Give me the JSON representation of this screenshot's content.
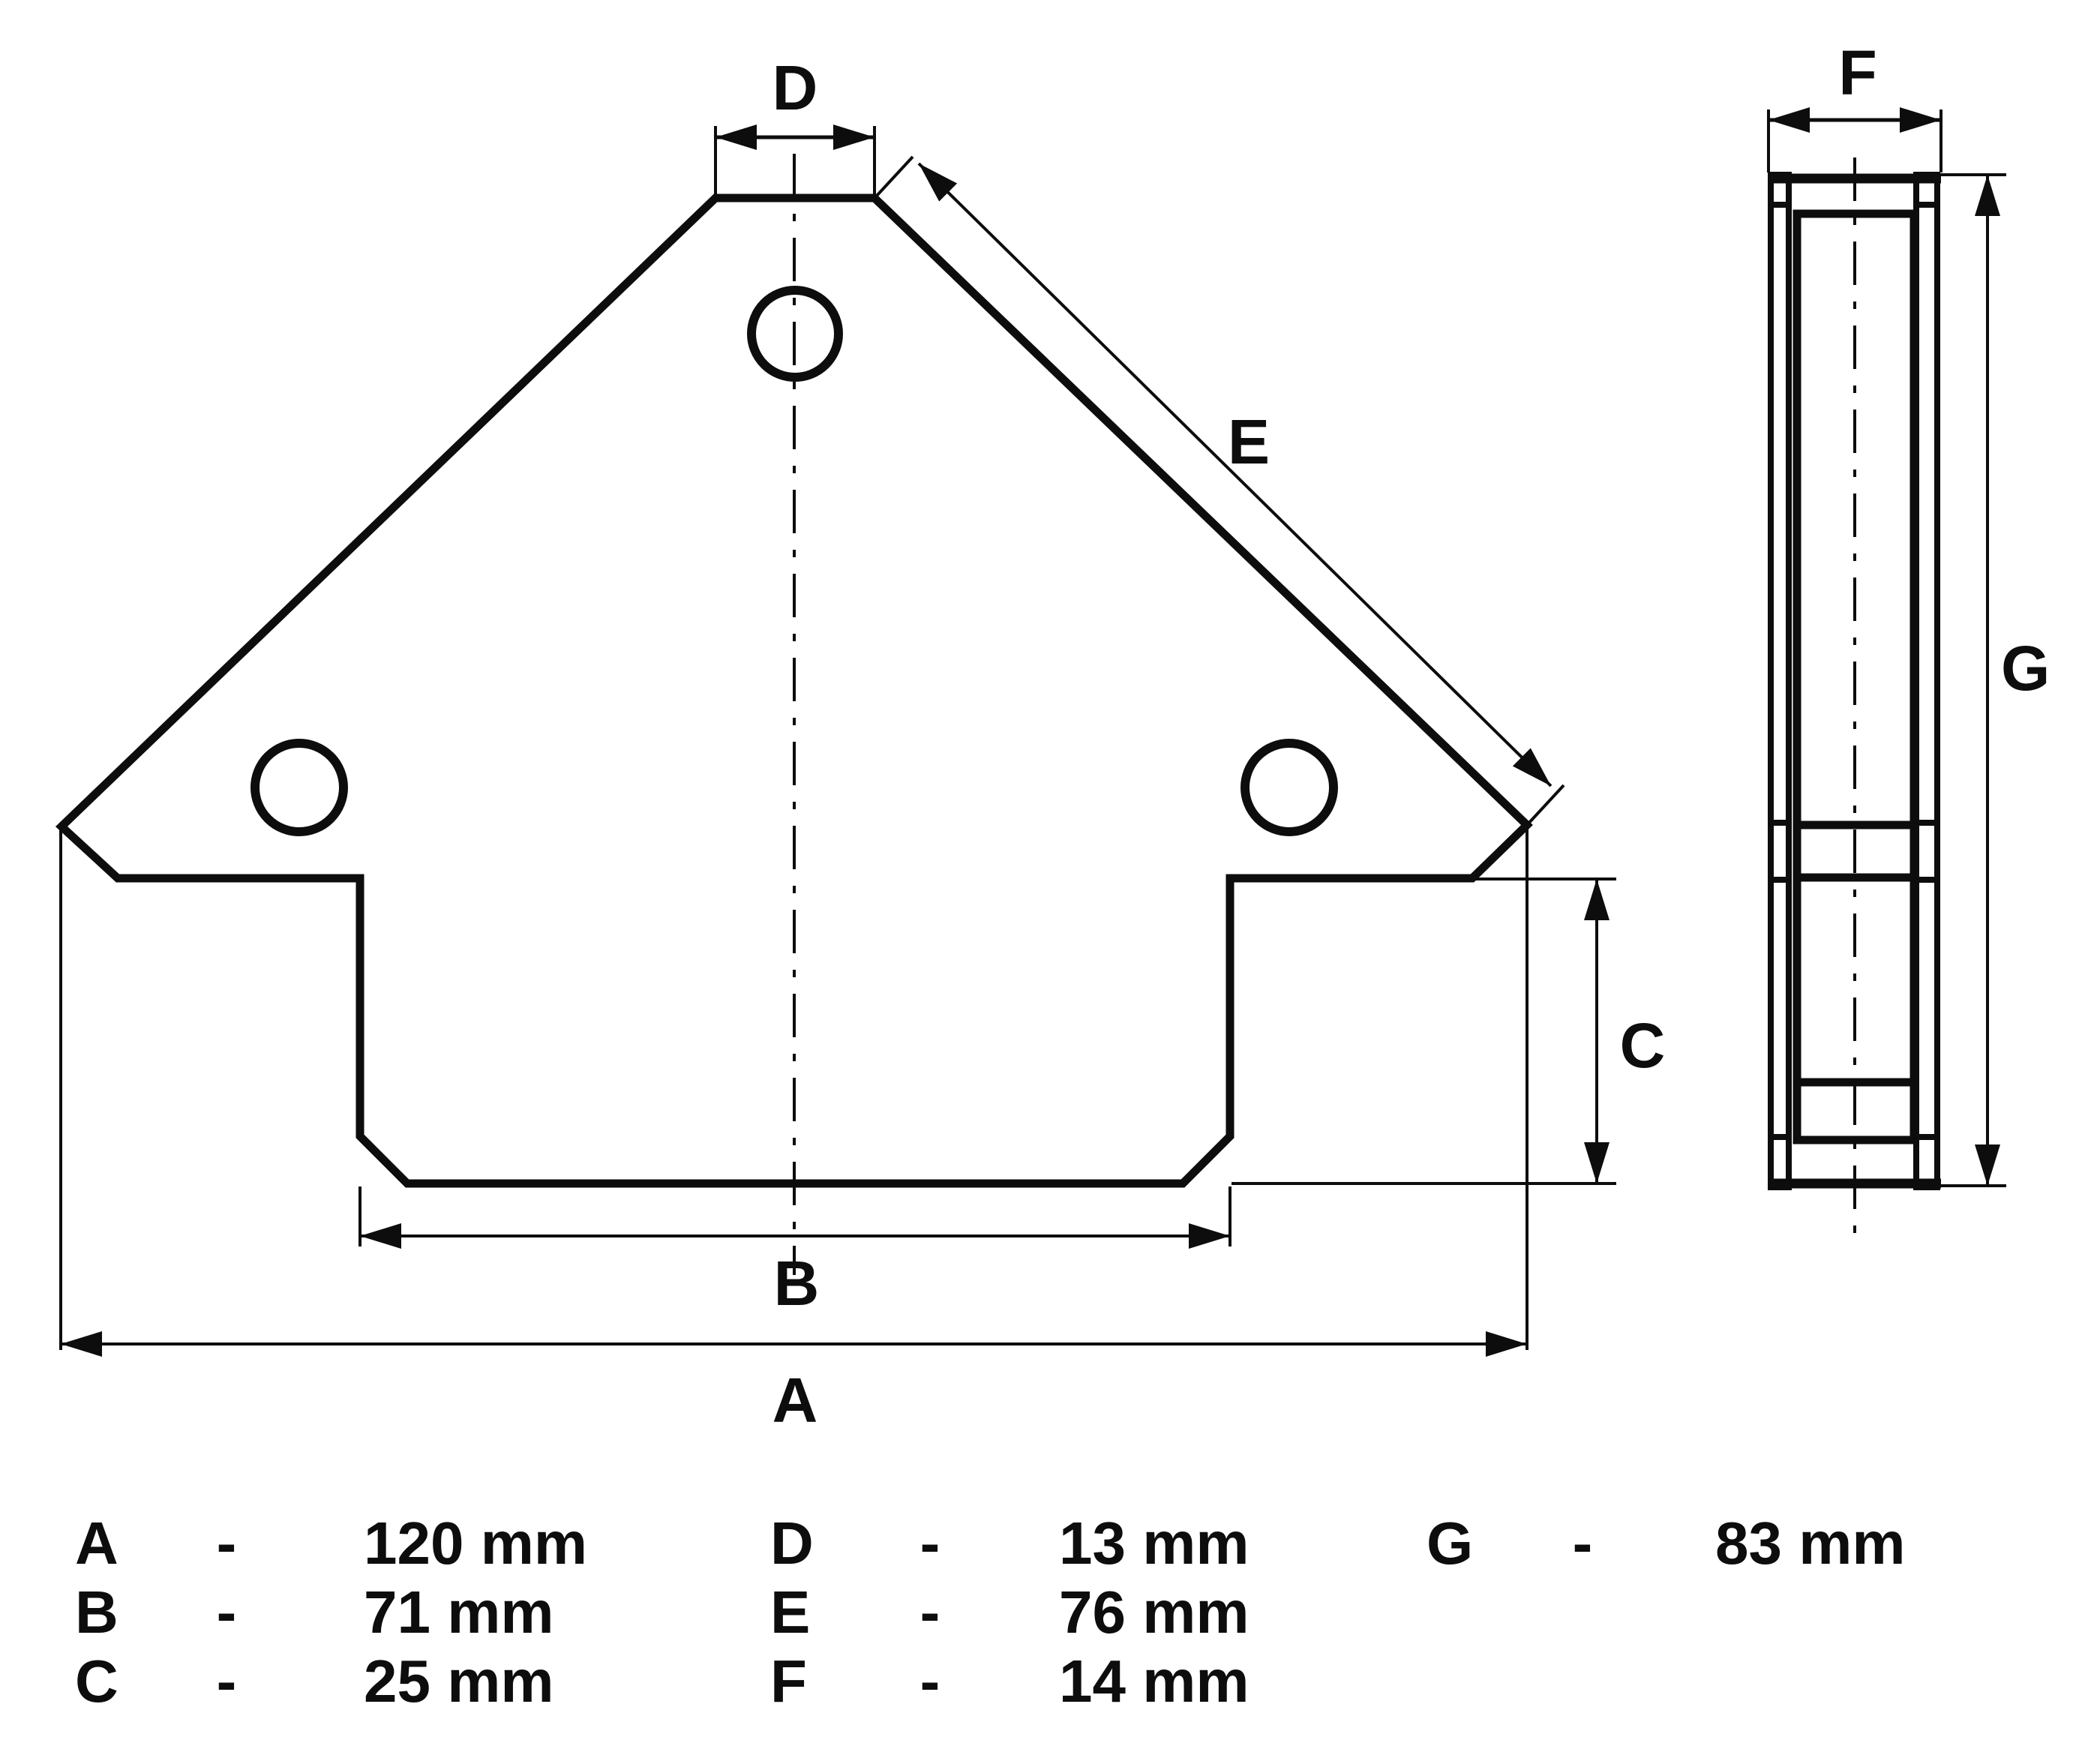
{
  "drawing": {
    "title": "welding-magnet-dimension-drawing",
    "colors": {
      "ink": "#0d0d0d",
      "background": "#ffffff"
    },
    "front_view": {
      "labels": {
        "A": "A",
        "B": "B",
        "C": "C",
        "D": "D",
        "E": "E"
      }
    },
    "side_view": {
      "labels": {
        "F": "F",
        "G": "G"
      }
    },
    "table": {
      "columns": [
        {
          "rows": [
            {
              "letter": "A",
              "separator": "-",
              "value": "120 mm"
            },
            {
              "letter": "B",
              "separator": "-",
              "value": "71 mm"
            },
            {
              "letter": "C",
              "separator": "-",
              "value": "25 mm"
            }
          ]
        },
        {
          "rows": [
            {
              "letter": "D",
              "separator": "-",
              "value": "13 mm"
            },
            {
              "letter": "E",
              "separator": "-",
              "value": "76 mm"
            },
            {
              "letter": "F",
              "separator": "-",
              "value": "14 mm"
            }
          ]
        },
        {
          "rows": [
            {
              "letter": "G",
              "separator": "-",
              "value": "83 mm"
            }
          ]
        }
      ]
    }
  }
}
